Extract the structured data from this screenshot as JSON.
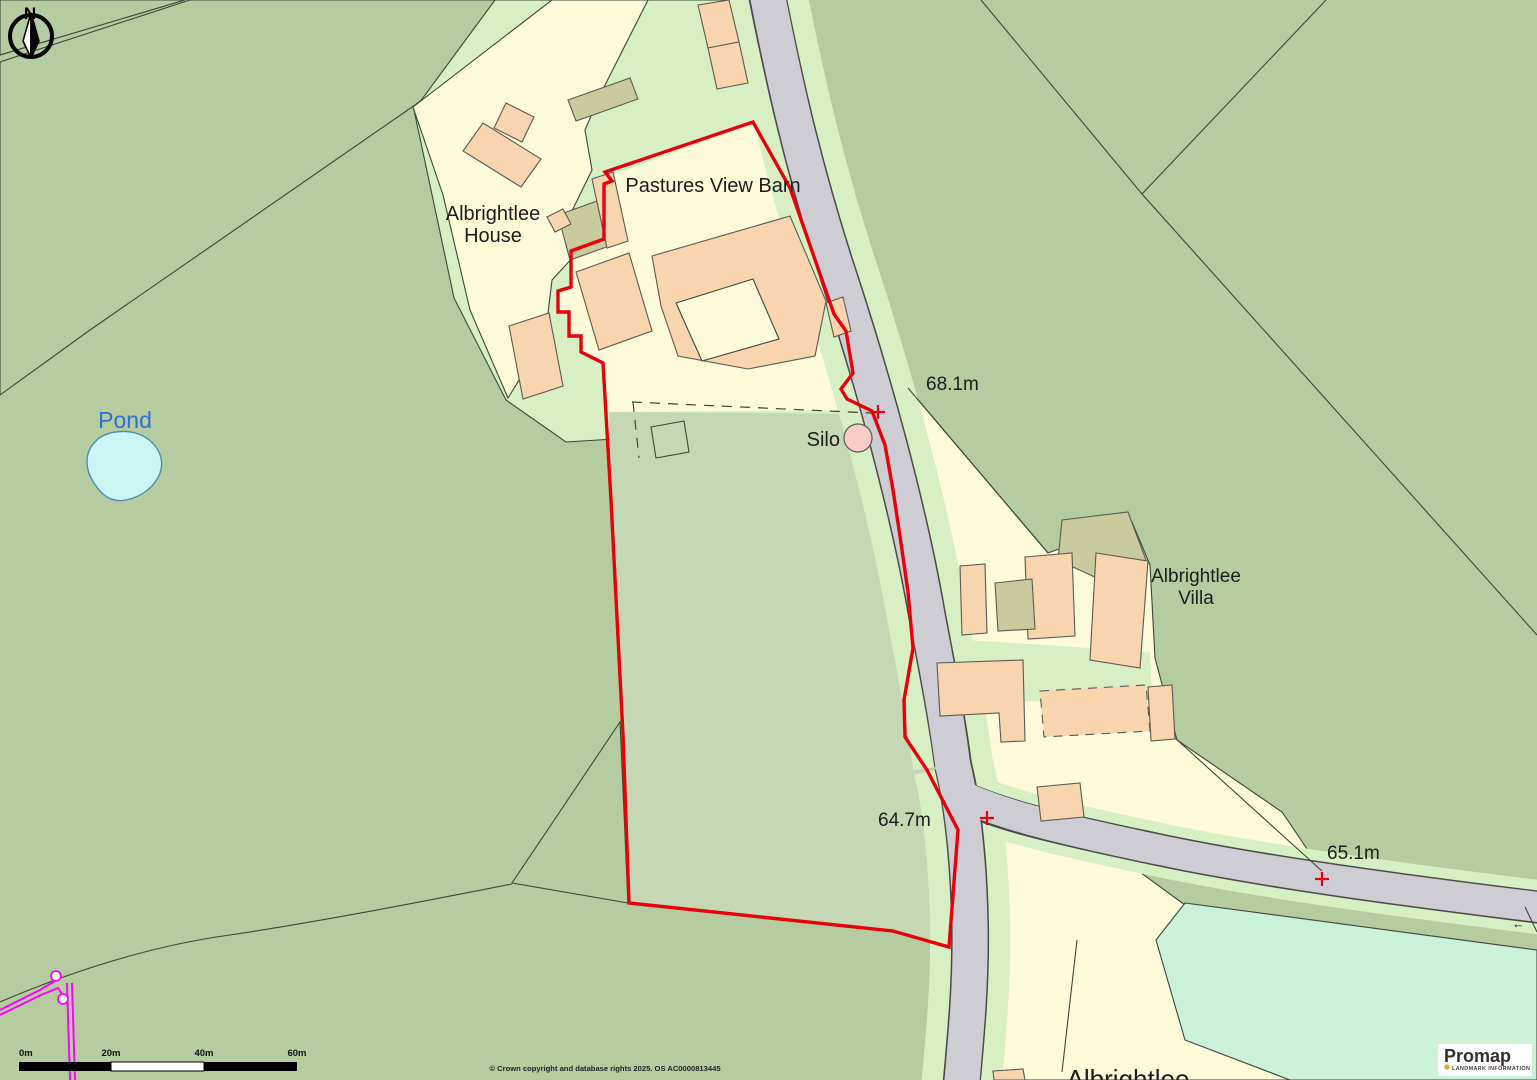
{
  "map": {
    "labels": {
      "pastures_view_barn": "Pastures View Barn",
      "albrightlee_house_line1": "Albrightlee",
      "albrightlee_house_line2": "House",
      "albrightlee_villa_line1": "Albrightlee",
      "albrightlee_villa_line2": "Villa",
      "albrightlee_partial": "Albrightlee",
      "pond": "Pond",
      "silo": "Silo",
      "flow_arrow": "←"
    },
    "spot_heights": [
      {
        "label": "68.1m"
      },
      {
        "label": "64.7m"
      },
      {
        "label": "65.1m"
      }
    ],
    "compass": {
      "north_label": "N"
    },
    "scale_bar": {
      "ticks": [
        "0m",
        "20m",
        "40m",
        "60m"
      ]
    },
    "copyright": "© Crown copyright and database rights 2025. OS AC0000813445",
    "branding": {
      "name": "Promap",
      "subtitle": "LANDMARK INFORMATION"
    },
    "colors": {
      "sage": "#b4cc9f",
      "sage_in": "#c6d8b3",
      "mint": "#cbf2d9",
      "verge": "#d8efc4",
      "cream": "#fdfada",
      "peach": "#f8d5ae",
      "khaki": "#c9cb9e",
      "road": "#cecdd3",
      "road_edge": "#4a4a4a",
      "pond_fill": "#cbf5f2",
      "pond_stroke": "#4d8fa6",
      "red": "#e8000a",
      "magenta": "#ff00ff",
      "line": "#3c463a",
      "bstroke": "#5a5a52",
      "text": "#1d1d1b",
      "pond_text": "#2f6fd6",
      "orange": "#f0a030"
    }
  }
}
